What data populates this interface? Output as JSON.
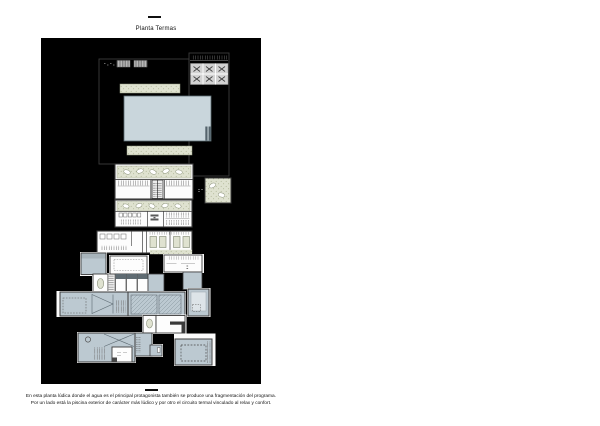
{
  "header": {
    "title": "Planta Termas"
  },
  "caption": {
    "line1": "En esta planta lúdica donde el agua es el principal protagonista también se produce una fragmentación del programa.",
    "line2": "Por un lado está la piscina exterior de carácter más lúdico y por otro el circuito termal vinculado al relax y confort."
  },
  "colors": {
    "paper": "#ffffff",
    "panel": "#000000",
    "text": "#111111",
    "wall": "#3c3c3c",
    "slab": "#fbfbfb",
    "joint": "#c9c9c9",
    "pool": "#c9d6dc",
    "thermal": "#bcc9d1",
    "thermal_light": "#dde4e8",
    "vegetation": "#dfe2d0",
    "vegetation_dot": "#a9b18e",
    "deck_gray": "#d2d2d2",
    "dark_fixture": "#55646c"
  }
}
